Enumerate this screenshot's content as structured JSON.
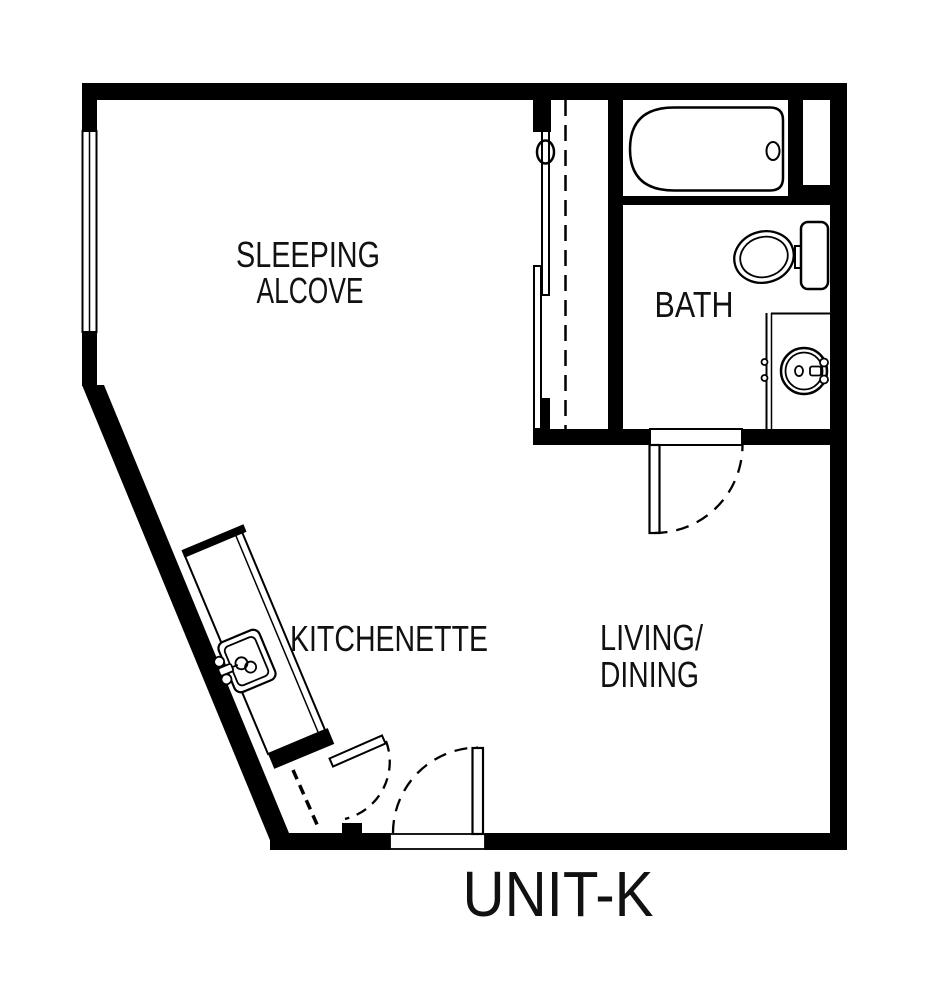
{
  "plan": {
    "title": "UNIT-K",
    "rooms": {
      "sleeping_alcove": {
        "line1": "SLEEPING",
        "line2": "ALCOVE"
      },
      "bath": {
        "label": "BATH"
      },
      "kitchenette": {
        "label": "KITCHENETTE"
      },
      "living_dining": {
        "line1": "LIVING/",
        "line2": "DINING"
      }
    },
    "fixtures": {
      "bathtub": "bathtub",
      "toilet": "toilet",
      "vanity_sink": "bathroom sink",
      "kitchen_sink": "kitchen sink",
      "closet": "closet with sliding doors",
      "window": "window",
      "entry_door": "entry door",
      "bath_door": "bath door",
      "utility_door": "utility closet door"
    },
    "colors": {
      "walls": "#000000",
      "background": "#ffffff",
      "text": "#111111"
    }
  }
}
